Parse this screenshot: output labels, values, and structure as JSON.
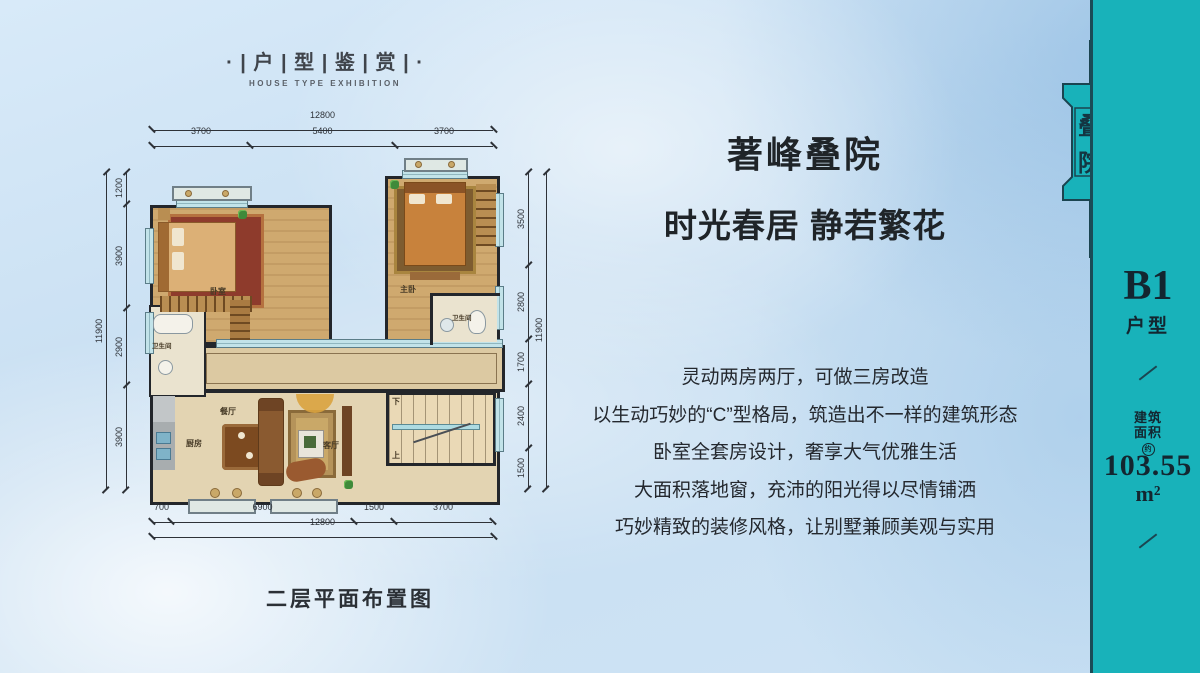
{
  "header": {
    "title": "· | 户 | 型 | 鉴 | 赏 | ·",
    "subtitle": "HOUSE TYPE EXHIBITION"
  },
  "hero": {
    "title_line1": "著峰叠院",
    "title_line2": "时光春居 静若繁花",
    "lines": [
      "灵动两房两厅，可做三房改造",
      "以生动巧妙的“C”型格局，筑造出不一样的建筑形态",
      "卧室全套房设计，奢享大气优雅生活",
      "大面积落地窗，充沛的阳光得以尽情铺洒",
      "巧妙精致的装修风格，让别墅兼顾美观与实用"
    ]
  },
  "sidebar": {
    "badge_char_top": "叠",
    "badge_char_bottom": "院",
    "unit_code": "B1",
    "unit_label": "户型",
    "area_label_line1": "建筑",
    "area_label_line2": "面积",
    "approx_mark": "约",
    "area_value": "103.55",
    "area_unit": "m²"
  },
  "plan": {
    "caption": "二层平面布置图",
    "rooms": {
      "bedroom": "卧室",
      "master": "主卧",
      "bath_left": "卫生间",
      "bath_master": "卫生间",
      "dining": "餐厅",
      "kitchen": "厨房",
      "living": "客厅",
      "stair_down": "下",
      "stair_up": "上"
    },
    "dims": {
      "top_total": "12800",
      "top_segments": [
        "3700",
        "5400",
        "3700"
      ],
      "bottom_segments": [
        "700",
        "6900",
        "1500",
        "3700"
      ],
      "bottom_total": "12800",
      "left_total": "11900",
      "left_segments": [
        "1200",
        "3900",
        "2900",
        "3900"
      ],
      "right_total": "11900",
      "right_segments": [
        "3500",
        "2800",
        "1700",
        "2400",
        "1500"
      ]
    }
  },
  "colors": {
    "sidebar_teal": "#18b2ba",
    "badge_ink": "#1a4450",
    "text_ink": "#23272d",
    "dim_ink": "#2e3238",
    "wall": "#23262b",
    "wood_floor": "#cfa96f",
    "marble_floor": "#e3d4b2",
    "window_glass": "#bfe2e8",
    "background_blue": "#cde2f4"
  }
}
